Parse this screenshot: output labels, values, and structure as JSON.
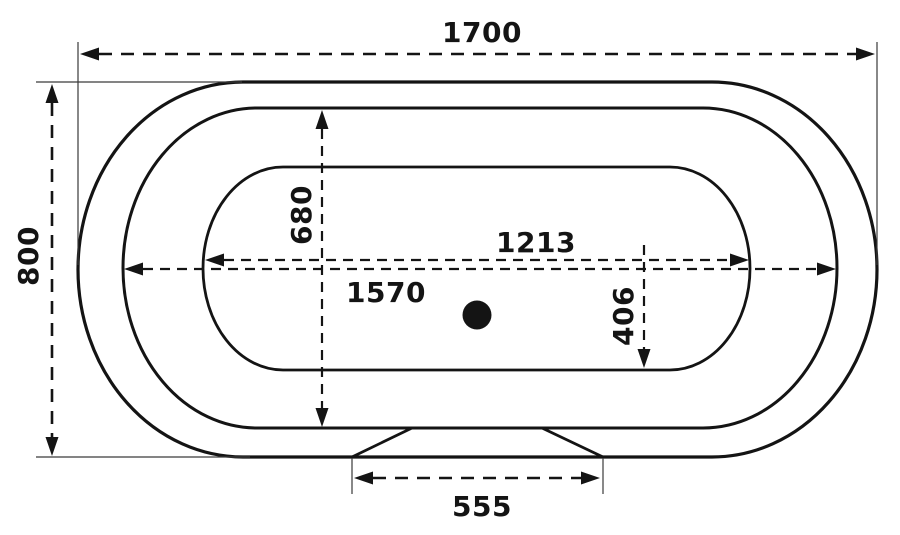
{
  "drawing": {
    "description": "bathtub-top-view-technical-drawing",
    "colors": {
      "background": "#ffffff",
      "line": "#141414",
      "extension_line": "#3a3a3a"
    },
    "icons": {
      "drain": "filled-circle"
    },
    "dimensions": {
      "overall_length": "1700",
      "overall_width": "800",
      "basin_width": "680",
      "basin_length": "1213",
      "rim_length": "1570",
      "basin_half_width": "406",
      "base_width": "555"
    }
  }
}
